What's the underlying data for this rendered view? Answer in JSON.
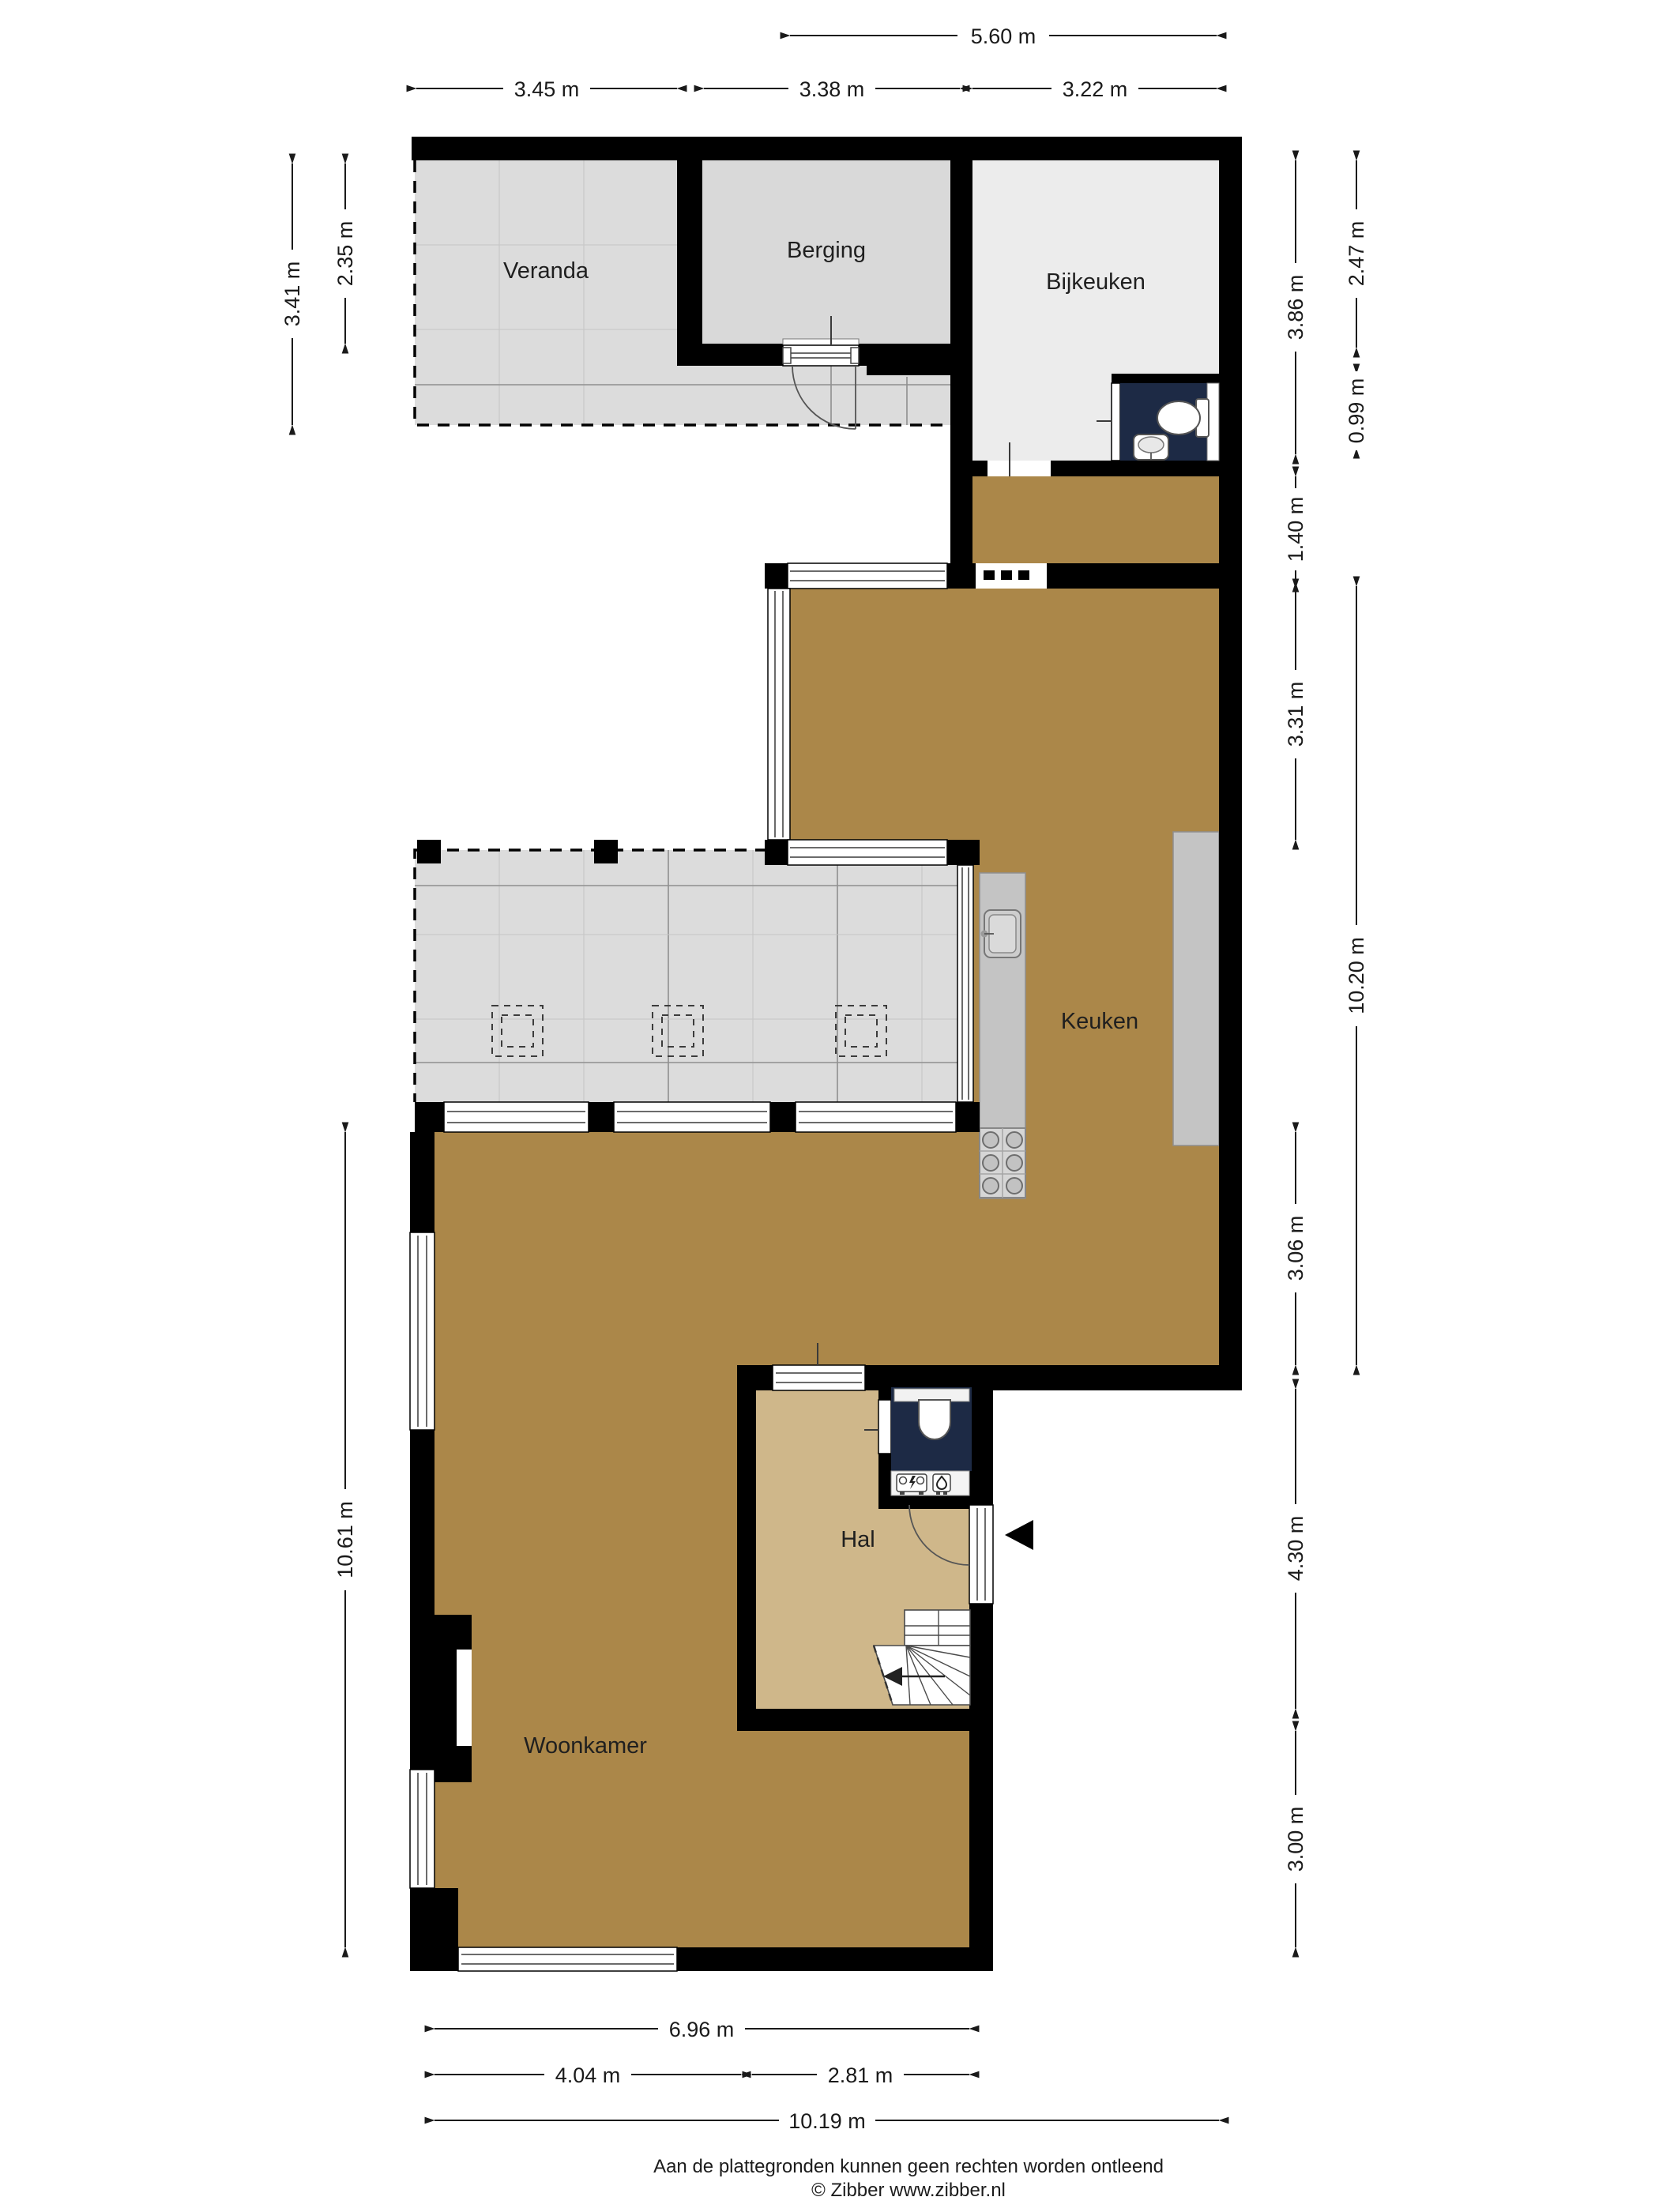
{
  "floorplan": {
    "type": "floor-plan",
    "rooms": [
      {
        "id": "veranda",
        "label": "Veranda"
      },
      {
        "id": "berging",
        "label": "Berging"
      },
      {
        "id": "bijkeuken",
        "label": "Bijkeuken"
      },
      {
        "id": "keuken",
        "label": "Keuken"
      },
      {
        "id": "hal",
        "label": "Hal"
      },
      {
        "id": "woonkamer",
        "label": "Woonkamer"
      }
    ],
    "dimensions": {
      "top": [
        {
          "label": "5.60 m"
        },
        {
          "label": "3.45 m"
        },
        {
          "label": "3.38 m"
        },
        {
          "label": "3.22 m"
        }
      ],
      "left": [
        {
          "label": "3.41 m"
        },
        {
          "label": "2.35 m"
        },
        {
          "label": "10.61 m"
        }
      ],
      "right": [
        {
          "label": "3.86 m"
        },
        {
          "label": "2.47 m"
        },
        {
          "label": "0.99 m"
        },
        {
          "label": "1.40 m"
        },
        {
          "label": "3.31 m"
        },
        {
          "label": "10.20 m"
        },
        {
          "label": "3.06 m"
        },
        {
          "label": "4.30 m"
        },
        {
          "label": "3.00 m"
        }
      ],
      "bottom": [
        {
          "label": "6.96 m"
        },
        {
          "label": "4.04 m"
        },
        {
          "label": "2.81 m"
        },
        {
          "label": "10.19 m"
        }
      ]
    },
    "colors": {
      "wall": "#000000",
      "floor_wood": "#ab8749",
      "floor_hal": "#cfb78a",
      "floor_tile": "#dcdcdc",
      "floor_berging": "#d9d9d9",
      "floor_bijkeuken": "#ececec",
      "toilet_room": "#1d2a45",
      "counter": "#c4c4c4",
      "stove": "#d6d6d6"
    },
    "footer": {
      "disclaimer": "Aan de plattegronden kunnen geen rechten worden ontleend",
      "copyright": "© Zibber www.zibber.nl"
    }
  }
}
